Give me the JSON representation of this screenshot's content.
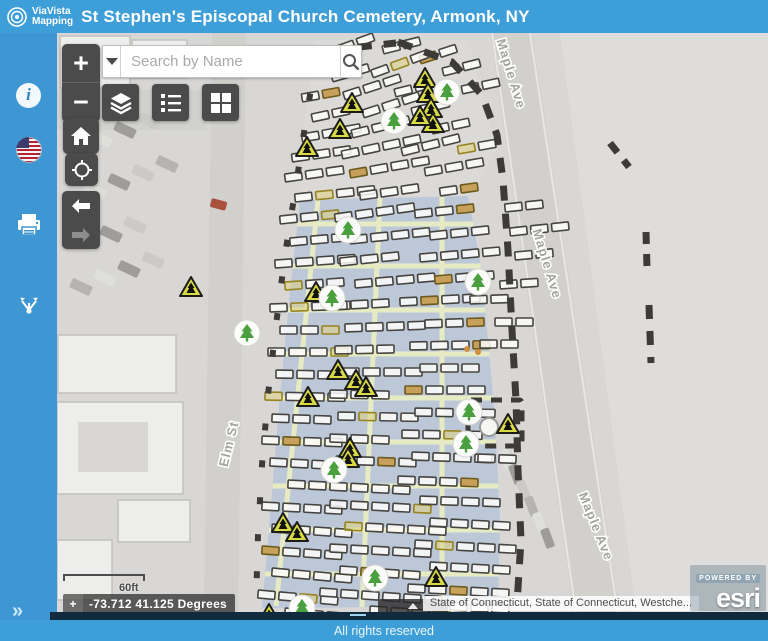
{
  "header": {
    "logo_line1": "ViaVista",
    "logo_line2": "Mapping",
    "title": "St Stephen's Episcopal Church Cemetery, Armonk, NY"
  },
  "sidebar": {
    "items": [
      {
        "name": "info"
      },
      {
        "name": "usa-flag"
      },
      {
        "name": "print"
      },
      {
        "name": "share"
      }
    ],
    "expand_label": "»"
  },
  "controls": {
    "zoom_in": "+",
    "zoom_out": "−",
    "search_placeholder": "Search by Name"
  },
  "widgets": {
    "scale_label": "60ft",
    "coordinates": "-73.712 41.125 Degrees",
    "attribution": "State of Connecticut, State of Connecticut, Westche...",
    "powered_by": "POWERED BY",
    "esri_brand": "esri",
    "footer": "All rights reserved"
  },
  "map": {
    "colors": {
      "base": "#d8d7d5",
      "field": "#dedddb",
      "road": "#d1d0cd",
      "road_edge": "#e7e6e4",
      "patch": "#dcdbd8",
      "section_blue": "#b7c5d8",
      "path_green": "#e9eec2",
      "plot_stroke": "#46443f",
      "plot_fill": "rgba(252,252,250,0.85)",
      "olive_stroke": "#97831f",
      "olive_fill": "rgba(222,209,130,0.55)",
      "tan_stroke": "#6d5a1d",
      "tan_fill": "#c7a05c",
      "boundary": "#3c3b38",
      "tree_green": "#4aa03e",
      "tri_fill": "#d9da44",
      "label_gray": "#a3a39f",
      "building_fill": "#ededeb",
      "building_stroke": "#c2c1be"
    },
    "street_labels": [
      {
        "text": "Maple Ave",
        "x": 507,
        "y": 75,
        "rot": 73
      },
      {
        "text": "Maple Ave",
        "x": 543,
        "y": 265,
        "rot": 73
      },
      {
        "text": "Maple Ave",
        "x": 592,
        "y": 528,
        "rot": 68
      },
      {
        "text": "Elm St",
        "x": 233,
        "y": 445,
        "rot": -76
      }
    ],
    "band": "300,200 468,196 480,260 488,340 495,420 500,520 498,606 262,608 271,505 280,395 290,292",
    "upper_patch": "315,40 468,40 497,150 470,196 300,200 305,120",
    "grid_v": [
      [
        318,
        200,
        276,
        606
      ],
      [
        380,
        198,
        362,
        607
      ],
      [
        442,
        196,
        442,
        607
      ]
    ],
    "grid_h_y": [
      224,
      266,
      310,
      354,
      398,
      442,
      486,
      530,
      574
    ],
    "boundary_paths": [
      {
        "d": "M398 42 L452 62 482 95 497 135 503 180 508 250 512 330 516 400 518 470 521 540 517 604",
        "w": 7,
        "dash": "15 13"
      },
      {
        "d": "M332 50 L396 43",
        "w": 7,
        "dash": "14 12"
      },
      {
        "d": "M316 57 L306 120 296 185 285 255 276 325 268 395 262 465 258 535 256 604",
        "w": 6,
        "dash": "7 30"
      },
      {
        "d": "M610 143 L629 167",
        "w": 7,
        "dash": "12 10"
      },
      {
        "d": "M646 232 L647 268",
        "w": 7,
        "dash": "12 10"
      },
      {
        "d": "M649 305 L651 363",
        "w": 7,
        "dash": "14 12"
      }
    ],
    "enclosure": {
      "x": 468,
      "y": 400,
      "w": 54,
      "h": 46,
      "cx": 489,
      "cy": 427,
      "r": 9
    },
    "plot_rows": [
      [
        318,
        57,
        -20,
        3
      ],
      [
        383,
        50,
        -14,
        2
      ],
      [
        420,
        60,
        -18,
        2
      ],
      [
        332,
        78,
        -16,
        2
      ],
      [
        372,
        74,
        -20,
        3
      ],
      [
        443,
        72,
        -14,
        2
      ],
      [
        302,
        98,
        -10,
        2
      ],
      [
        344,
        96,
        -18,
        3
      ],
      [
        395,
        93,
        -14,
        2
      ],
      [
        462,
        90,
        -12,
        2
      ],
      [
        312,
        118,
        -12,
        2
      ],
      [
        363,
        114,
        -18,
        3
      ],
      [
        412,
        112,
        -14,
        2
      ],
      [
        302,
        138,
        -10,
        3
      ],
      [
        352,
        134,
        -14,
        3
      ],
      [
        432,
        130,
        -12,
        2
      ],
      [
        292,
        158,
        -8,
        3
      ],
      [
        342,
        155,
        -12,
        4
      ],
      [
        402,
        152,
        -14,
        3
      ],
      [
        458,
        150,
        -10,
        2
      ],
      [
        285,
        178,
        -8,
        3
      ],
      [
        350,
        174,
        -10,
        4
      ],
      [
        425,
        172,
        -10,
        3
      ],
      [
        295,
        198,
        -6,
        4
      ],
      [
        360,
        196,
        -8,
        3
      ],
      [
        440,
        192,
        -8,
        2
      ],
      [
        505,
        208,
        -6,
        2
      ],
      [
        280,
        220,
        -6,
        3
      ],
      [
        335,
        218,
        -8,
        4
      ],
      [
        415,
        214,
        -6,
        3
      ],
      [
        510,
        232,
        -6,
        3
      ],
      [
        290,
        242,
        -5,
        3
      ],
      [
        350,
        240,
        -6,
        4
      ],
      [
        430,
        236,
        -6,
        3
      ],
      [
        515,
        256,
        -5,
        2
      ],
      [
        275,
        264,
        -4,
        4
      ],
      [
        340,
        262,
        -6,
        3
      ],
      [
        420,
        258,
        -5,
        4
      ],
      [
        285,
        286,
        -4,
        3
      ],
      [
        355,
        284,
        -5,
        4
      ],
      [
        435,
        280,
        -5,
        3
      ],
      [
        500,
        285,
        -4,
        2
      ],
      [
        270,
        308,
        -2,
        4
      ],
      [
        330,
        306,
        -3,
        3
      ],
      [
        400,
        302,
        -3,
        4
      ],
      [
        470,
        300,
        -2,
        2
      ],
      [
        280,
        330,
        0,
        3
      ],
      [
        345,
        328,
        -2,
        4
      ],
      [
        425,
        324,
        -2,
        3
      ],
      [
        495,
        322,
        0,
        2
      ],
      [
        268,
        352,
        0,
        4
      ],
      [
        335,
        350,
        -1,
        3
      ],
      [
        410,
        346,
        -1,
        4
      ],
      [
        480,
        344,
        0,
        2
      ],
      [
        276,
        374,
        1,
        3
      ],
      [
        342,
        372,
        0,
        4
      ],
      [
        420,
        368,
        0,
        3
      ],
      [
        265,
        396,
        1,
        4
      ],
      [
        330,
        394,
        1,
        3
      ],
      [
        405,
        390,
        0,
        4
      ],
      [
        272,
        418,
        2,
        3
      ],
      [
        338,
        416,
        1,
        4
      ],
      [
        415,
        412,
        1,
        4
      ],
      [
        262,
        440,
        2,
        4
      ],
      [
        330,
        438,
        2,
        3
      ],
      [
        402,
        434,
        1,
        4
      ],
      [
        270,
        462,
        3,
        3
      ],
      [
        336,
        460,
        2,
        4
      ],
      [
        412,
        456,
        2,
        4
      ],
      [
        478,
        458,
        2,
        2
      ],
      [
        288,
        484,
        3,
        6
      ],
      [
        398,
        480,
        2,
        4
      ],
      [
        262,
        506,
        3,
        4
      ],
      [
        330,
        504,
        3,
        5
      ],
      [
        420,
        500,
        2,
        4
      ],
      [
        272,
        528,
        4,
        4
      ],
      [
        345,
        526,
        3,
        5
      ],
      [
        430,
        522,
        3,
        4
      ],
      [
        262,
        550,
        4,
        4
      ],
      [
        330,
        548,
        3,
        5
      ],
      [
        415,
        544,
        3,
        5
      ],
      [
        272,
        572,
        5,
        4
      ],
      [
        340,
        570,
        4,
        4
      ],
      [
        430,
        566,
        3,
        4
      ],
      [
        258,
        594,
        5,
        4
      ],
      [
        320,
        592,
        4,
        6
      ],
      [
        408,
        588,
        3,
        5
      ],
      [
        285,
        612,
        5,
        4
      ],
      [
        370,
        610,
        4,
        4
      ],
      [
        450,
        606,
        3,
        3
      ]
    ],
    "trees": [
      [
        447,
        92
      ],
      [
        394,
        121
      ],
      [
        348,
        230
      ],
      [
        478,
        282
      ],
      [
        332,
        298
      ],
      [
        247,
        333
      ],
      [
        469,
        412
      ],
      [
        466,
        444
      ],
      [
        334,
        470
      ],
      [
        375,
        578
      ],
      [
        302,
        608
      ]
    ],
    "triangles": [
      [
        425,
        78
      ],
      [
        428,
        93
      ],
      [
        431,
        108
      ],
      [
        433,
        123
      ],
      [
        352,
        103
      ],
      [
        340,
        129
      ],
      [
        307,
        147
      ],
      [
        420,
        116
      ],
      [
        191,
        287
      ],
      [
        316,
        292
      ],
      [
        338,
        370
      ],
      [
        356,
        380
      ],
      [
        366,
        387
      ],
      [
        308,
        397
      ],
      [
        350,
        448
      ],
      [
        348,
        458
      ],
      [
        508,
        424
      ],
      [
        283,
        523
      ],
      [
        297,
        532
      ],
      [
        269,
        614
      ],
      [
        436,
        577
      ]
    ],
    "roads": {
      "maple": "490,33 532,33 624,641 578,641",
      "elm": "212,33 246,33 238,612 204,612",
      "field": "560,33 768,33 768,641 640,641",
      "maple_edges": [
        [
          492,
          33,
          580,
          641
        ],
        [
          530,
          33,
          622,
          641
        ]
      ]
    },
    "buildings": [
      [
        58,
        335,
        118,
        58
      ],
      [
        57,
        402,
        126,
        92
      ],
      [
        118,
        500,
        72,
        42
      ],
      [
        57,
        540,
        55,
        60
      ],
      [
        60,
        36,
        70,
        52
      ],
      [
        132,
        40,
        55,
        38
      ]
    ],
    "building_insets": [
      [
        78,
        422,
        70,
        50
      ]
    ],
    "cars_tl": [
      [
        66,
        143
      ],
      [
        90,
        134
      ],
      [
        114,
        125
      ],
      [
        138,
        116
      ],
      [
        162,
        107
      ],
      [
        84,
        186
      ],
      [
        108,
        177
      ],
      [
        132,
        168
      ],
      [
        156,
        159
      ],
      [
        76,
        238
      ],
      [
        100,
        229
      ],
      [
        124,
        220
      ],
      [
        70,
        282
      ],
      [
        94,
        273
      ],
      [
        118,
        264
      ],
      [
        142,
        255
      ]
    ],
    "cars_br": [
      [
        497,
        455
      ],
      [
        506,
        470
      ],
      [
        514,
        486
      ],
      [
        522,
        502
      ],
      [
        530,
        518
      ],
      [
        538,
        534
      ]
    ],
    "red_car": [
      212,
      198,
      16,
      9,
      15
    ],
    "dots": [
      [
        478,
        352
      ],
      [
        467,
        349
      ]
    ]
  }
}
